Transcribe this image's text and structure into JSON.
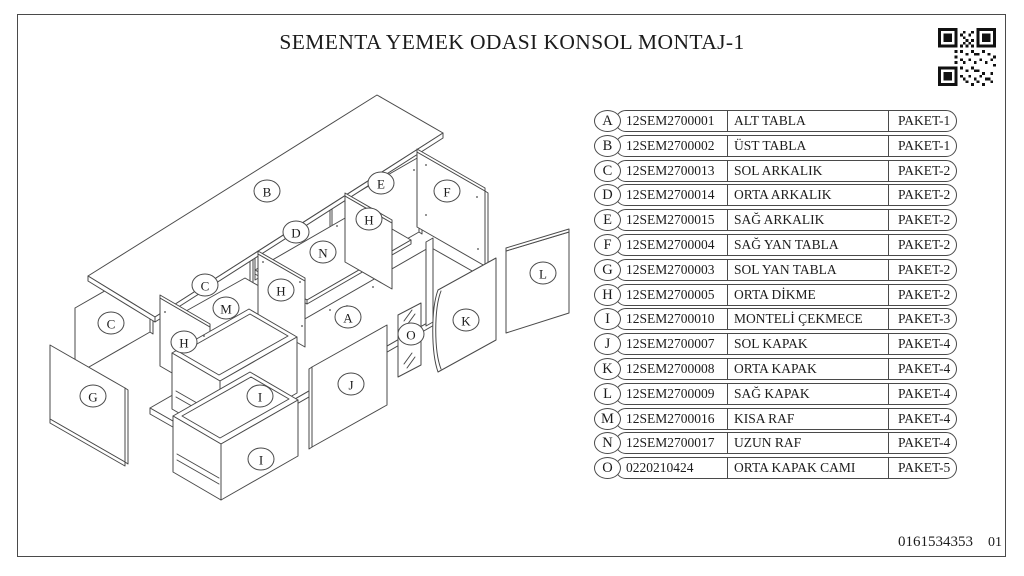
{
  "title": "SEMENTA YEMEK ODASI KONSOL MONTAJ-1",
  "doc_number": "0161534353",
  "page_number": "01",
  "colors": {
    "line": "#4a4a4a",
    "text": "#1c1c1c",
    "background": "#ffffff"
  },
  "parts_table": {
    "rows": [
      {
        "letter": "A",
        "code": "12SEM2700001",
        "name": "ALT TABLA",
        "package": "PAKET-1"
      },
      {
        "letter": "B",
        "code": "12SEM2700002",
        "name": "ÜST TABLA",
        "package": "PAKET-1"
      },
      {
        "letter": "C",
        "code": "12SEM2700013",
        "name": "SOL ARKALIK",
        "package": "PAKET-2"
      },
      {
        "letter": "D",
        "code": "12SEM2700014",
        "name": "ORTA ARKALIK",
        "package": "PAKET-2"
      },
      {
        "letter": "E",
        "code": "12SEM2700015",
        "name": "SAĞ ARKALIK",
        "package": "PAKET-2"
      },
      {
        "letter": "F",
        "code": "12SEM2700004",
        "name": "SAĞ YAN TABLA",
        "package": "PAKET-2"
      },
      {
        "letter": "G",
        "code": "12SEM2700003",
        "name": "SOL YAN TABLA",
        "package": "PAKET-2"
      },
      {
        "letter": "H",
        "code": "12SEM2700005",
        "name": "ORTA DİKME",
        "package": "PAKET-2"
      },
      {
        "letter": "I",
        "code": "12SEM2700010",
        "name": "MONTELİ ÇEKMECE",
        "package": "PAKET-3"
      },
      {
        "letter": "J",
        "code": "12SEM2700007",
        "name": "SOL KAPAK",
        "package": "PAKET-4"
      },
      {
        "letter": "K",
        "code": "12SEM2700008",
        "name": "ORTA KAPAK",
        "package": "PAKET-4"
      },
      {
        "letter": "L",
        "code": "12SEM2700009",
        "name": "SAĞ KAPAK",
        "package": "PAKET-4"
      },
      {
        "letter": "M",
        "code": "12SEM2700016",
        "name": "KISA RAF",
        "package": "PAKET-4"
      },
      {
        "letter": "N",
        "code": "12SEM2700017",
        "name": "UZUN RAF",
        "package": "PAKET-4"
      },
      {
        "letter": "O",
        "code": "0220210424",
        "name": "ORTA KAPAK CAMI",
        "package": "PAKET-5"
      }
    ]
  },
  "diagram": {
    "labels": [
      "A",
      "B",
      "C",
      "C",
      "D",
      "E",
      "F",
      "G",
      "H",
      "H",
      "H",
      "I",
      "I",
      "J",
      "K",
      "L",
      "M",
      "N",
      "O"
    ]
  }
}
